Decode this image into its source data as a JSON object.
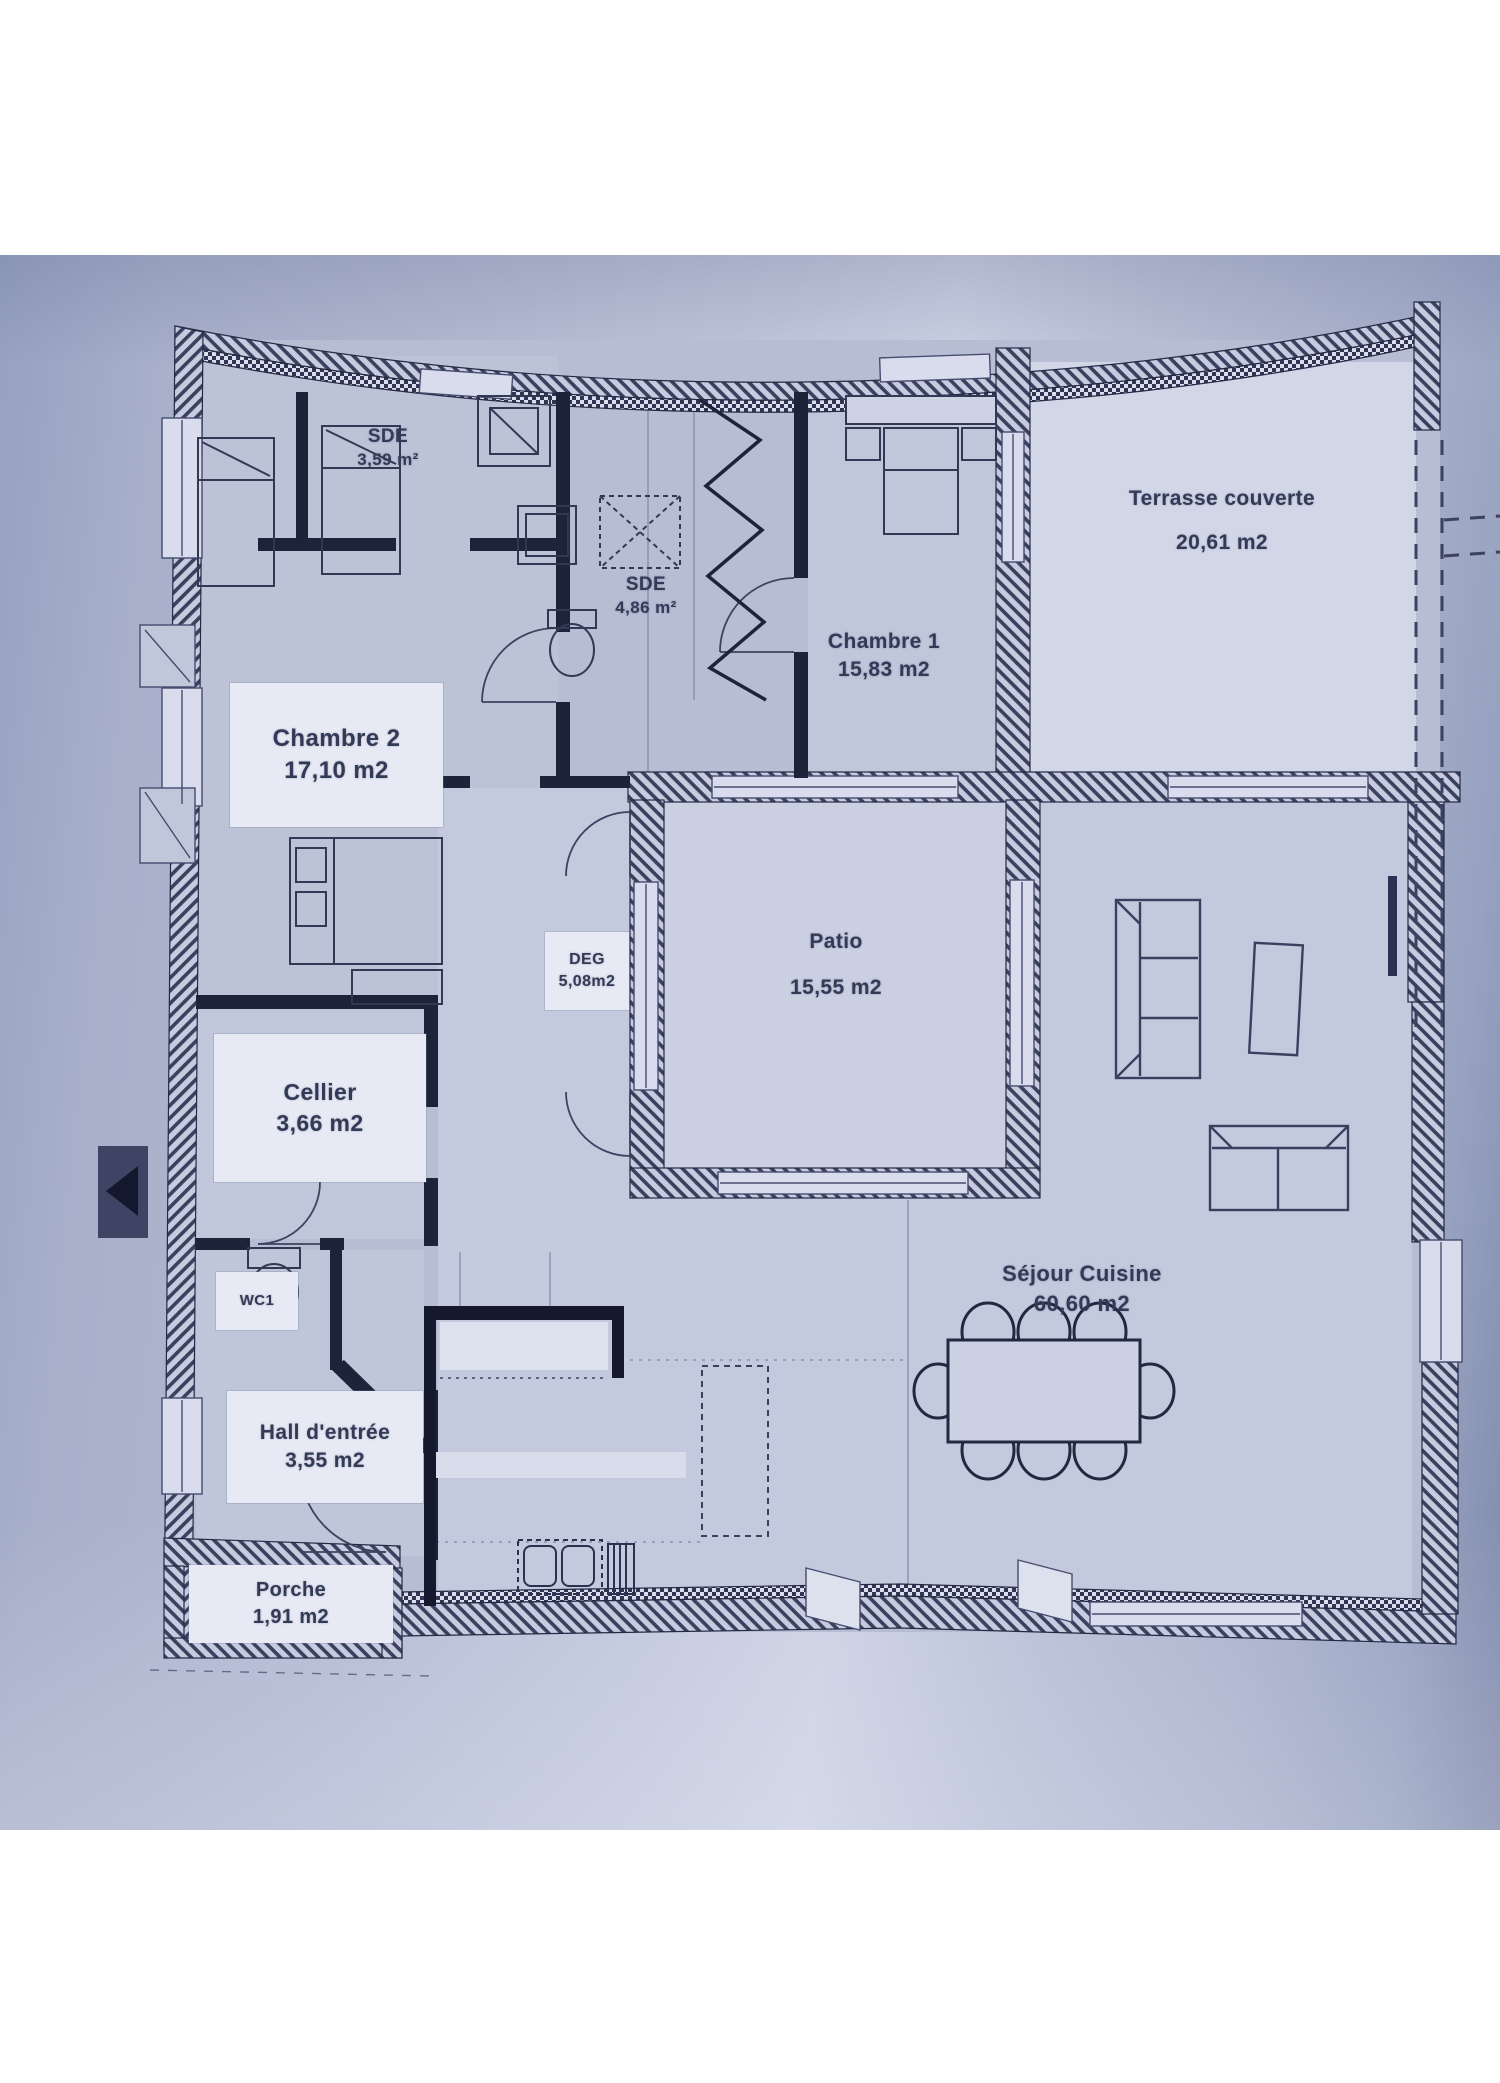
{
  "title": "Plan de maison - rez-de-chaussée",
  "colors": {
    "paper": "#b9c0d6",
    "ink": "#2b3150",
    "label_box": "#e7eaf4",
    "terrace_highlight": "#d2d7e8"
  },
  "rooms": {
    "sde1": {
      "name": "SDE",
      "area": "3,59 m²"
    },
    "sde2": {
      "name": "SDE",
      "area": "4,86 m²"
    },
    "chambre1": {
      "name": "Chambre 1",
      "area": "15,83 m2"
    },
    "terrasse": {
      "name": "Terrasse couverte",
      "area": "20,61 m2"
    },
    "chambre2": {
      "name": "Chambre 2",
      "area": "17,10 m2"
    },
    "deg": {
      "name": "DEG",
      "area": "5,08m2"
    },
    "patio": {
      "name": "Patio",
      "area": "15,55 m2"
    },
    "cellier": {
      "name": "Cellier",
      "area": "3,66 m2"
    },
    "wc": {
      "name": "WC1"
    },
    "hall": {
      "name": "Hall d'entrée",
      "area": "3,55 m2"
    },
    "porche": {
      "name": "Porche",
      "area": "1,91 m2"
    },
    "sejour": {
      "name": "Séjour Cuisine",
      "area": "60,60 m2"
    }
  }
}
